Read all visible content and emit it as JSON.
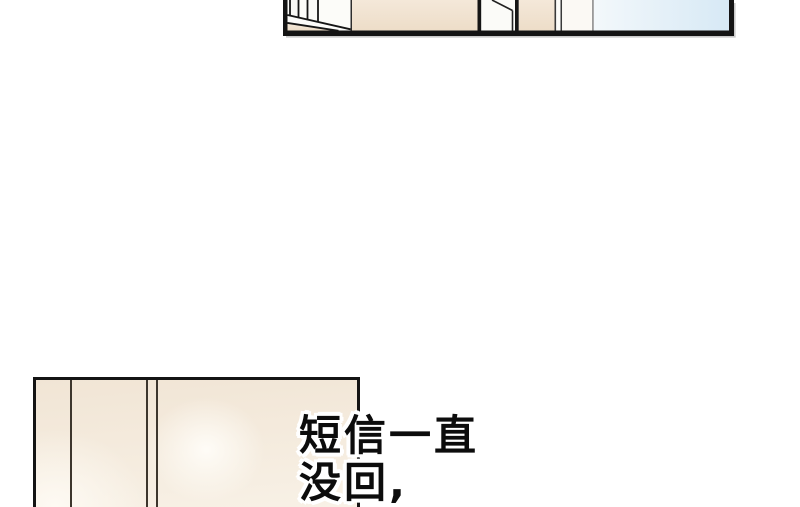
{
  "speech": {
    "line1": "短信一直",
    "line2": "没回,"
  },
  "colors": {
    "page_background": "#ffffff",
    "panel_border_black": "#141414",
    "wall_beige": "#f1e3d1",
    "wall_cream": "#f4ebdd",
    "near_white": "#fcfcf9",
    "sky_blue_light": "#f3f8fb",
    "sky_blue_deep": "#d7e9f5",
    "glow_white": "#fffdf8",
    "text_color": "#0c0c0c",
    "text_outline": "#ffffff"
  }
}
